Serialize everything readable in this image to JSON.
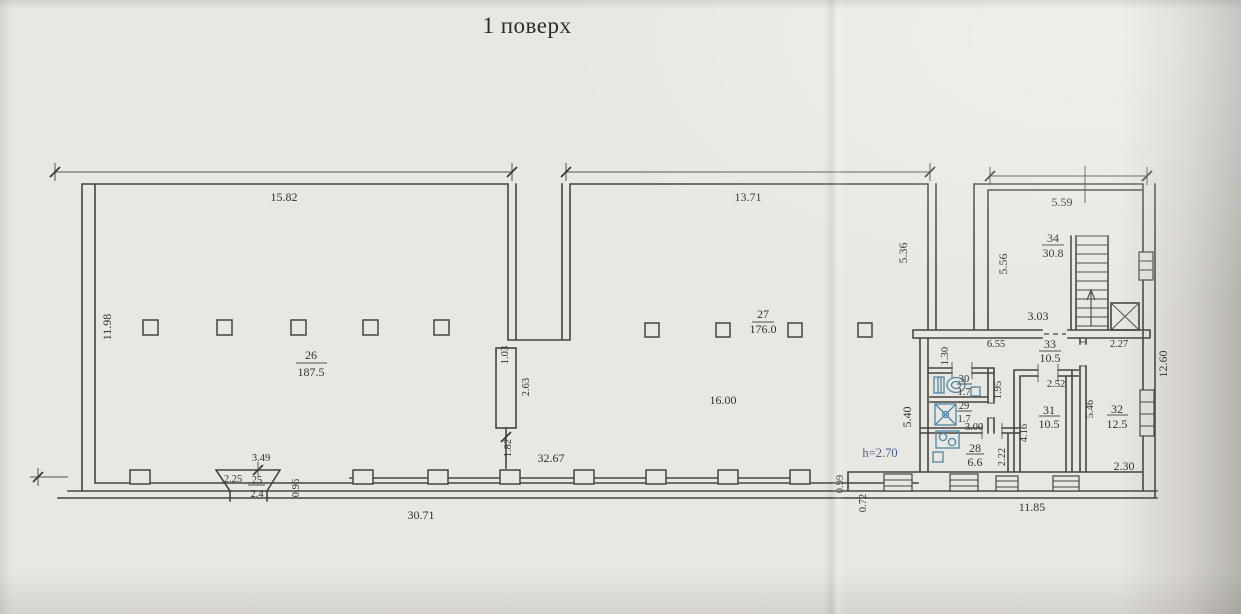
{
  "title": "1 поверх",
  "colors": {
    "ink": "#47443f",
    "fixture_blue": "#4e86a6",
    "note_blue": "#4a5d96",
    "paper": "#e9e7e2"
  },
  "rooms": {
    "r25": {
      "num": "25",
      "area": "2.4"
    },
    "r26": {
      "num": "26",
      "area": "187.5"
    },
    "r27": {
      "num": "27",
      "area": "176.0"
    },
    "r28": {
      "num": "28",
      "area": "6.6"
    },
    "r29": {
      "num": "29",
      "area": "1.7"
    },
    "r30": {
      "num": "30",
      "area": "1.7"
    },
    "r31": {
      "num": "31",
      "area": "10.5"
    },
    "r32": {
      "num": "32",
      "area": "12.5"
    },
    "r33": {
      "num": "33",
      "area": "10.5"
    },
    "r34": {
      "num": "34",
      "area": "30.8"
    }
  },
  "dims": {
    "d15_82": "15.82",
    "d13_71": "13.71",
    "d5_59": "5.59",
    "d11_98": "11.98",
    "d1_03": "1.03",
    "d2_63": "2.63",
    "d1_82": "1.82",
    "d32_67": "32.67",
    "d16_00": "16.00",
    "d5_36": "5.36",
    "d5_40": "5.40",
    "d5_56": "5.56",
    "d1_30": "1.30",
    "d3_03": "3.03",
    "d6_55": "6.55",
    "d2_27": "2.27",
    "d12_60": "12.60",
    "d1_95": "1.95",
    "d3_00": "3.00",
    "d2_52": "2.52",
    "d4_16": "4.16",
    "d2_22": "2.22",
    "d5_46": "5.46",
    "d2_30": "2.30",
    "d11_85": "11.85",
    "d30_71": "30.71",
    "d3_49": "3.49",
    "d2_25": "2.25",
    "d0_96": "0.96",
    "d0_99": "0.99",
    "d0_72": "0.72",
    "height_note": "h=2.70"
  }
}
